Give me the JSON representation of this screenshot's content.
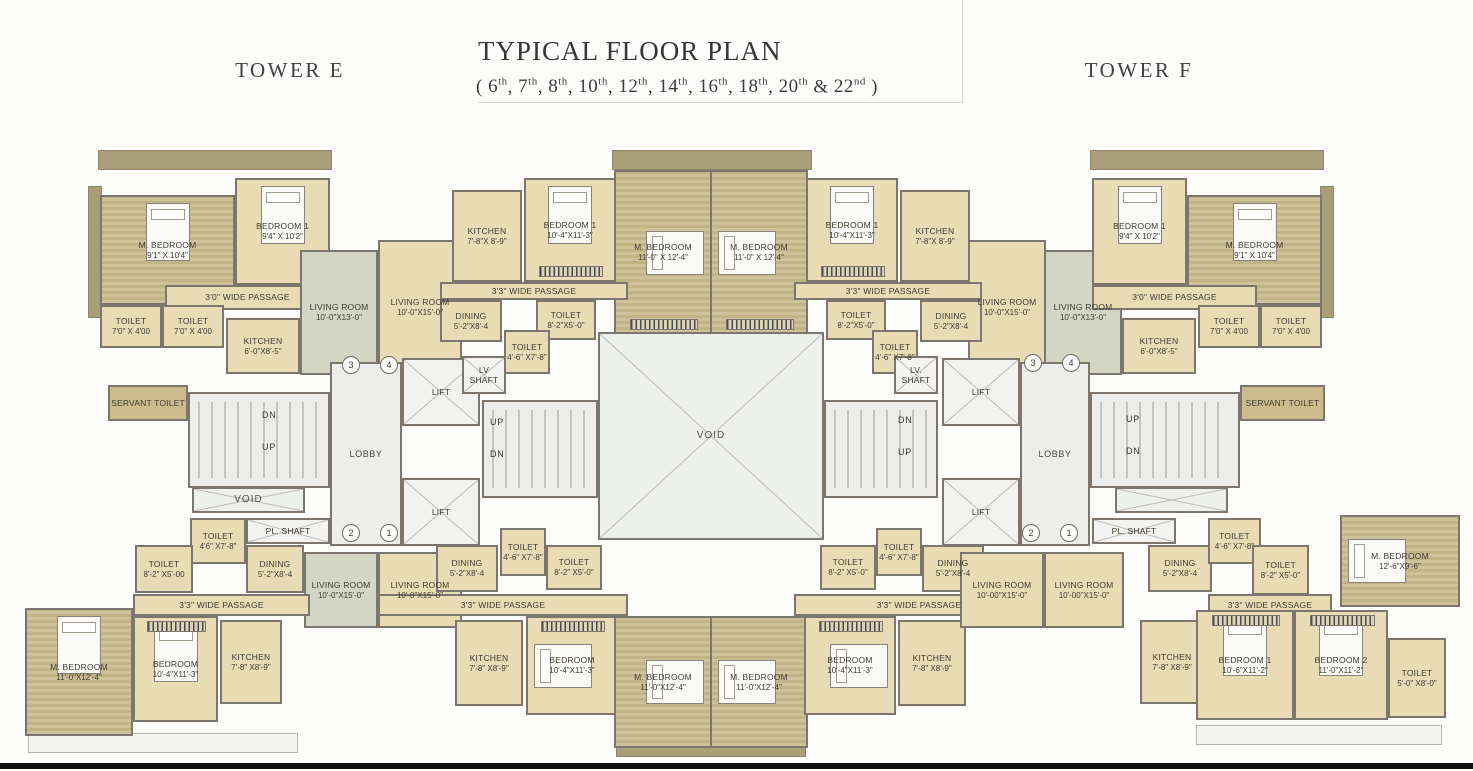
{
  "header": {
    "tower_left": "TOWER E",
    "title": "TYPICAL FLOOR PLAN",
    "floors_open": "(",
    "floors": [
      {
        "n": "6",
        "s": "th"
      },
      {
        "n": "7",
        "s": "th"
      },
      {
        "n": "8",
        "s": "th"
      },
      {
        "n": "10",
        "s": "th"
      },
      {
        "n": "12",
        "s": "th"
      },
      {
        "n": "14",
        "s": "th"
      },
      {
        "n": "16",
        "s": "th"
      },
      {
        "n": "18",
        "s": "th"
      },
      {
        "n": "20",
        "s": "th"
      },
      {
        "n": "22",
        "s": "nd"
      }
    ],
    "floors_close": ")",
    "tower_right": "TOWER F"
  },
  "colors": {
    "wall": "#7c766e",
    "room_cream": "#e9dcb4",
    "bedroom_khaki": "#cfc199",
    "living_sage": "#d3d6c4",
    "deck_olive": "#a89f79",
    "core_gray": "#ededeb",
    "servant_khaki": "#cbbb8d",
    "footer_black": "#121212"
  },
  "plan": {
    "rooms": [
      {
        "id": "deck-left",
        "t": "olive",
        "x": 88,
        "y": 186,
        "w": 14,
        "h": 132
      },
      {
        "id": "deck-top-left",
        "t": "olive",
        "x": 98,
        "y": 150,
        "w": 234,
        "h": 20
      },
      {
        "id": "deck-top-center",
        "t": "olive",
        "x": 612,
        "y": 150,
        "w": 200,
        "h": 20
      },
      {
        "id": "deck-top-right",
        "t": "olive",
        "x": 1090,
        "y": 150,
        "w": 234,
        "h": 20
      },
      {
        "id": "deck-right",
        "t": "olive",
        "x": 1320,
        "y": 186,
        "w": 14,
        "h": 132
      },
      {
        "id": "deck-bottom-left",
        "t": "white",
        "x": 28,
        "y": 733,
        "w": 270,
        "h": 20
      },
      {
        "id": "deck-bottom-center",
        "t": "olive",
        "x": 616,
        "y": 745,
        "w": 190,
        "h": 12
      },
      {
        "id": "deck-bottom-right",
        "t": "white",
        "x": 1196,
        "y": 725,
        "w": 246,
        "h": 20
      },
      {
        "id": "e1-mbedroom",
        "t": "khaki",
        "x": 100,
        "y": 195,
        "w": 135,
        "h": 110,
        "l": "M. BEDROOM",
        "d": "9'1\" X 10'4\"",
        "bed": "v"
      },
      {
        "id": "e1-bedroom1",
        "t": "cream",
        "x": 235,
        "y": 178,
        "w": 95,
        "h": 107,
        "l": "BEDROOM 1",
        "d": "9'4\" X 10'2\"",
        "bed": "v"
      },
      {
        "id": "e1-passage",
        "t": "cream",
        "x": 165,
        "y": 285,
        "w": 165,
        "h": 25,
        "l": "3'0\" WIDE PASSAGE"
      },
      {
        "id": "e1-toilet-1",
        "t": "cream",
        "x": 100,
        "y": 305,
        "w": 62,
        "h": 43,
        "l": "TOILET",
        "d": "7'0\" X 4'00"
      },
      {
        "id": "e1-toilet-2",
        "t": "cream",
        "x": 162,
        "y": 305,
        "w": 62,
        "h": 43,
        "l": "TOILET",
        "d": "7'0\" X 4'00"
      },
      {
        "id": "e1-kitchen",
        "t": "cream",
        "x": 226,
        "y": 318,
        "w": 74,
        "h": 56,
        "l": "KITCHEN",
        "d": "6'-0\"X8'-5\""
      },
      {
        "id": "e1-living",
        "t": "sage",
        "x": 300,
        "y": 250,
        "w": 78,
        "h": 125,
        "l": "LIVING ROOM",
        "d": "10'-0\"X13'-0\""
      },
      {
        "id": "e2-living",
        "t": "cream",
        "x": 378,
        "y": 240,
        "w": 84,
        "h": 135,
        "l": "LIVING ROOM",
        "d": "10'-0\"X15'-0\""
      },
      {
        "id": "e2-kitchen",
        "t": "cream",
        "x": 452,
        "y": 190,
        "w": 70,
        "h": 92,
        "l": "KITCHEN",
        "d": "7'-8\"X 8'-9\""
      },
      {
        "id": "e2-bedroom1",
        "t": "cream",
        "x": 524,
        "y": 178,
        "w": 92,
        "h": 104,
        "l": "BEDROOM 1",
        "d": "10'-4\"X11'-3\"",
        "bed": "v",
        "wr": "b"
      },
      {
        "id": "e2-mbedroom",
        "t": "khaki",
        "x": 614,
        "y": 170,
        "w": 98,
        "h": 165,
        "l": "M. BEDROOM",
        "d": "11'-0\" X 12'-4\"",
        "bed": "hr",
        "wr": "b"
      },
      {
        "id": "e2-passage",
        "t": "cream",
        "x": 440,
        "y": 282,
        "w": 188,
        "h": 18,
        "l": "3'3\" WIDE PASSAGE"
      },
      {
        "id": "e2-dining",
        "t": "cream",
        "x": 440,
        "y": 300,
        "w": 62,
        "h": 42,
        "l": "DINING",
        "d": "5'-2\"X8'-4"
      },
      {
        "id": "e2-toilet-82",
        "t": "cream",
        "x": 536,
        "y": 300,
        "w": 60,
        "h": 40,
        "l": "TOILET",
        "d": "8'-2\"X5'-0\""
      },
      {
        "id": "e2-toilet-46",
        "t": "cream",
        "x": 504,
        "y": 330,
        "w": 46,
        "h": 44,
        "l": "TOILET",
        "d": "4'-6\" X7'-8\""
      },
      {
        "id": "f2-mbedroom",
        "t": "khaki",
        "x": 710,
        "y": 170,
        "w": 98,
        "h": 165,
        "l": "M. BEDROOM",
        "d": "11'-0\" X 12'-4\"",
        "bed": "h",
        "wr": "b"
      },
      {
        "id": "f2-bedroom1",
        "t": "cream",
        "x": 806,
        "y": 178,
        "w": 92,
        "h": 104,
        "l": "BEDROOM 1",
        "d": "10'-4\"X11'-3\"",
        "bed": "v",
        "wr": "b"
      },
      {
        "id": "f2-kitchen",
        "t": "cream",
        "x": 900,
        "y": 190,
        "w": 70,
        "h": 92,
        "l": "KITCHEN",
        "d": "7'-8\"X 8'-9\""
      },
      {
        "id": "f2-living",
        "t": "cream",
        "x": 968,
        "y": 240,
        "w": 78,
        "h": 135,
        "l": "LIVING ROOM",
        "d": "10'-0\"X15'-0\""
      },
      {
        "id": "f2-passage",
        "t": "cream",
        "x": 794,
        "y": 282,
        "w": 188,
        "h": 18,
        "l": "3'3\" WIDE PASSAGE"
      },
      {
        "id": "f2-dining",
        "t": "cream",
        "x": 920,
        "y": 300,
        "w": 62,
        "h": 42,
        "l": "DINING",
        "d": "5'-2\"X8'-4"
      },
      {
        "id": "f2-toilet-82",
        "t": "cream",
        "x": 826,
        "y": 300,
        "w": 60,
        "h": 40,
        "l": "TOILET",
        "d": "8'-2\"X5'-0\""
      },
      {
        "id": "f2-toilet-46",
        "t": "cream",
        "x": 872,
        "y": 330,
        "w": 46,
        "h": 44,
        "l": "TOILET",
        "d": "4'-6\" X7'-8\""
      },
      {
        "id": "f1-living",
        "t": "sage",
        "x": 1044,
        "y": 250,
        "w": 78,
        "h": 125,
        "l": "LIVING ROOM",
        "d": "10'-0\"X13'-0\""
      },
      {
        "id": "f1-bedroom1",
        "t": "cream",
        "x": 1092,
        "y": 178,
        "w": 95,
        "h": 107,
        "l": "BEDROOM 1",
        "d": "9'4\" X 10'2\"",
        "bed": "v"
      },
      {
        "id": "f1-mbedroom",
        "t": "khaki",
        "x": 1187,
        "y": 195,
        "w": 135,
        "h": 110,
        "l": "M. BEDROOM",
        "d": "9'1\" X 10'4\"",
        "bed": "v"
      },
      {
        "id": "f1-passage",
        "t": "cream",
        "x": 1092,
        "y": 285,
        "w": 165,
        "h": 25,
        "l": "3'0\" WIDE PASSAGE"
      },
      {
        "id": "f1-kitchen",
        "t": "cream",
        "x": 1122,
        "y": 318,
        "w": 74,
        "h": 56,
        "l": "KITCHEN",
        "d": "6'-0\"X8'-5\""
      },
      {
        "id": "f1-toilet-1",
        "t": "cream",
        "x": 1198,
        "y": 305,
        "w": 62,
        "h": 43,
        "l": "TOILET",
        "d": "7'0\" X 4'00"
      },
      {
        "id": "f1-toilet-2",
        "t": "cream",
        "x": 1260,
        "y": 305,
        "w": 62,
        "h": 43,
        "l": "TOILET",
        "d": "7'0\" X 4'00"
      },
      {
        "id": "servant-toilet-left",
        "t": "servant",
        "x": 108,
        "y": 385,
        "w": 80,
        "h": 36,
        "l": "SERVANT TOILET"
      },
      {
        "id": "stair-left",
        "t": "core",
        "x": 188,
        "y": 392,
        "w": 142,
        "h": 96,
        "st": 1
      },
      {
        "id": "void-left",
        "t": "void",
        "x": 192,
        "y": 487,
        "w": 113,
        "h": 26,
        "l": "VOID"
      },
      {
        "id": "e3-toilet-46",
        "t": "cream",
        "x": 190,
        "y": 518,
        "w": 56,
        "h": 46,
        "l": "TOILET",
        "d": "4'6\" X7'-8\""
      },
      {
        "id": "pl-shaft-left",
        "t": "shaft",
        "x": 246,
        "y": 518,
        "w": 84,
        "h": 26,
        "l": "PL. SHAFT"
      },
      {
        "id": "lobby-left",
        "t": "core",
        "x": 330,
        "y": 362,
        "w": 72,
        "h": 184,
        "l": "LOBBY"
      },
      {
        "id": "lift-left-1",
        "t": "lift",
        "x": 402,
        "y": 358,
        "w": 78,
        "h": 68,
        "l": "LIFT"
      },
      {
        "id": "lift-left-2",
        "t": "lift",
        "x": 402,
        "y": 478,
        "w": 78,
        "h": 68,
        "l": "LIFT"
      },
      {
        "id": "lv-shaft-left",
        "t": "shaft",
        "x": 462,
        "y": 356,
        "w": 44,
        "h": 38,
        "l": "LV SHAFT"
      },
      {
        "id": "stair-mid-left",
        "t": "core",
        "x": 482,
        "y": 400,
        "w": 116,
        "h": 98,
        "st": 1
      },
      {
        "id": "void-center",
        "t": "void",
        "x": 598,
        "y": 332,
        "w": 226,
        "h": 208,
        "l": "VOID"
      },
      {
        "id": "stair-mid-right",
        "t": "core",
        "x": 824,
        "y": 400,
        "w": 114,
        "h": 98,
        "st": 1
      },
      {
        "id": "lv-shaft-right",
        "t": "shaft",
        "x": 894,
        "y": 356,
        "w": 44,
        "h": 38,
        "l": "LV. SHAFT"
      },
      {
        "id": "lift-right-1",
        "t": "lift",
        "x": 942,
        "y": 358,
        "w": 78,
        "h": 68,
        "l": "LIFT"
      },
      {
        "id": "lift-right-2",
        "t": "lift",
        "x": 942,
        "y": 478,
        "w": 78,
        "h": 68,
        "l": "LIFT"
      },
      {
        "id": "lobby-right",
        "t": "core",
        "x": 1020,
        "y": 362,
        "w": 70,
        "h": 184,
        "l": "LOBBY"
      },
      {
        "id": "stair-right",
        "t": "core",
        "x": 1090,
        "y": 392,
        "w": 150,
        "h": 96,
        "st": 1
      },
      {
        "id": "void-right",
        "t": "void",
        "x": 1115,
        "y": 487,
        "w": 113,
        "h": 26
      },
      {
        "id": "pl-shaft-right",
        "t": "shaft",
        "x": 1092,
        "y": 518,
        "w": 84,
        "h": 26,
        "l": "PL. SHAFT"
      },
      {
        "id": "servant-toilet-right",
        "t": "servant",
        "x": 1240,
        "y": 385,
        "w": 85,
        "h": 36,
        "l": "SERVANT TOILET"
      },
      {
        "id": "e3-toilet-82",
        "t": "cream",
        "x": 135,
        "y": 545,
        "w": 58,
        "h": 48,
        "l": "TOILET",
        "d": "8'-2\" X5'-00"
      },
      {
        "id": "e3-dining",
        "t": "cream",
        "x": 246,
        "y": 545,
        "w": 58,
        "h": 48,
        "l": "DINING",
        "d": "5'-2\"X8'-4"
      },
      {
        "id": "e3-living",
        "t": "sage",
        "x": 304,
        "y": 552,
        "w": 74,
        "h": 76,
        "l": "LIVING ROOM",
        "d": "10'-0\"X15'-0\""
      },
      {
        "id": "e3-passage",
        "t": "cream",
        "x": 133,
        "y": 594,
        "w": 177,
        "h": 22,
        "l": "3'3\" WIDE PASSAGE"
      },
      {
        "id": "e3-mbedroom",
        "t": "khaki",
        "x": 25,
        "y": 608,
        "w": 108,
        "h": 128,
        "l": "M. BEDROOM",
        "d": "11'-0\"X12'-4\"",
        "bed": "v"
      },
      {
        "id": "e3-bedroom",
        "t": "cream",
        "x": 133,
        "y": 616,
        "w": 85,
        "h": 106,
        "l": "BEDROOM",
        "d": "10'-4\"X11'-3\"",
        "bed": "v",
        "wr": "t"
      },
      {
        "id": "e3-kitchen",
        "t": "cream",
        "x": 220,
        "y": 620,
        "w": 62,
        "h": 84,
        "l": "KITCHEN",
        "d": "7'-8\" X8'-9\""
      },
      {
        "id": "e4-living",
        "t": "cream",
        "x": 378,
        "y": 552,
        "w": 84,
        "h": 76,
        "l": "LIVING ROOM",
        "d": "10'-0\"X15'-0\""
      },
      {
        "id": "e4-dining",
        "t": "cream",
        "x": 436,
        "y": 545,
        "w": 62,
        "h": 47,
        "l": "DINING",
        "d": "5'-2\"X8'-4"
      },
      {
        "id": "e4-toilet-46",
        "t": "cream",
        "x": 500,
        "y": 528,
        "w": 46,
        "h": 48,
        "l": "TOILET",
        "d": "4'-6\" X7'-8\""
      },
      {
        "id": "e4-toilet-82",
        "t": "cream",
        "x": 546,
        "y": 545,
        "w": 56,
        "h": 45,
        "l": "TOILET",
        "d": "8'-2\" X5'-0\""
      },
      {
        "id": "e4-passage",
        "t": "cream",
        "x": 378,
        "y": 594,
        "w": 250,
        "h": 22,
        "l": "3'3\" WIDE PASSAGE"
      },
      {
        "id": "e4-kitchen",
        "t": "cream",
        "x": 455,
        "y": 620,
        "w": 68,
        "h": 86,
        "l": "KITCHEN",
        "d": "7'-8\" X8'-9\""
      },
      {
        "id": "e4-bedroom",
        "t": "cream",
        "x": 526,
        "y": 616,
        "w": 92,
        "h": 99,
        "l": "BEDROOM",
        "d": "10'-4\"X11'-3\"",
        "bed": "h",
        "wr": "t"
      },
      {
        "id": "e4-mbedroom",
        "t": "khaki",
        "x": 614,
        "y": 616,
        "w": 98,
        "h": 132,
        "l": "M. BEDROOM",
        "d": "11'-0\"X12'-4\"",
        "bed": "hr"
      },
      {
        "id": "f3-mbedroom",
        "t": "khaki",
        "x": 710,
        "y": 616,
        "w": 98,
        "h": 132,
        "l": "M. BEDROOM",
        "d": "11'-0\"X12'-4\"",
        "bed": "h"
      },
      {
        "id": "f3-bedroom",
        "t": "cream",
        "x": 804,
        "y": 616,
        "w": 92,
        "h": 99,
        "l": "BEDROOM",
        "d": "10'-4\"X11'-3\"",
        "bed": "hr",
        "wr": "t"
      },
      {
        "id": "f3-kitchen",
        "t": "cream",
        "x": 898,
        "y": 620,
        "w": 68,
        "h": 86,
        "l": "KITCHEN",
        "d": "7'-8\" X8'-9\""
      },
      {
        "id": "f3-passage",
        "t": "cream",
        "x": 794,
        "y": 594,
        "w": 250,
        "h": 22,
        "l": "3'3\" WIDE PASSAGE"
      },
      {
        "id": "f3-toilet-82",
        "t": "cream",
        "x": 820,
        "y": 545,
        "w": 56,
        "h": 45,
        "l": "TOILET",
        "d": "8'-2\" X5'-0\""
      },
      {
        "id": "f3-toilet-46",
        "t": "cream",
        "x": 876,
        "y": 528,
        "w": 46,
        "h": 48,
        "l": "TOILET",
        "d": "4'-6\" X7'-8\""
      },
      {
        "id": "f3-dining",
        "t": "cream",
        "x": 922,
        "y": 545,
        "w": 62,
        "h": 47,
        "l": "DINING",
        "d": "5'-2\"X8'-4"
      },
      {
        "id": "f3-living-1",
        "t": "cream",
        "x": 960,
        "y": 552,
        "w": 84,
        "h": 76,
        "l": "LIVING ROOM",
        "d": "10'-00\"X15'-0\""
      },
      {
        "id": "f3-living-2",
        "t": "cream",
        "x": 1044,
        "y": 552,
        "w": 80,
        "h": 76,
        "l": "LIVING ROOM",
        "d": "10'-00\"X15'-0\""
      },
      {
        "id": "f4-dining",
        "t": "cream",
        "x": 1148,
        "y": 545,
        "w": 64,
        "h": 47,
        "l": "DINING",
        "d": "5'-2\"X8'-4"
      },
      {
        "id": "f4-toilet-46",
        "t": "cream",
        "x": 1208,
        "y": 518,
        "w": 53,
        "h": 46,
        "l": "TOILET",
        "d": "4'-6\" X7'-8\""
      },
      {
        "id": "f4-toilet-82",
        "t": "cream",
        "x": 1252,
        "y": 545,
        "w": 57,
        "h": 50,
        "l": "TOILET",
        "d": "8'-2\" X5'-0\""
      },
      {
        "id": "f4-passage",
        "t": "cream",
        "x": 1208,
        "y": 594,
        "w": 124,
        "h": 22,
        "l": "3'3\" WIDE PASSAGE"
      },
      {
        "id": "f4-mbedroom",
        "t": "khaki",
        "x": 1340,
        "y": 515,
        "w": 120,
        "h": 92,
        "l": "M. BEDROOM",
        "d": "12'-6\"X9'-6\"",
        "bed": "h"
      },
      {
        "id": "f4-kitchen",
        "t": "cream",
        "x": 1140,
        "y": 620,
        "w": 64,
        "h": 84,
        "l": "KITCHEN",
        "d": "7'-8\" X8'-9\""
      },
      {
        "id": "f4-bedroom1",
        "t": "cream",
        "x": 1196,
        "y": 610,
        "w": 98,
        "h": 110,
        "l": "BEDROOM 1",
        "d": "10'-6\"X11'-2\"",
        "bed": "v",
        "wr": "t"
      },
      {
        "id": "f4-bedroom2",
        "t": "cream",
        "x": 1294,
        "y": 610,
        "w": 94,
        "h": 110,
        "l": "BEDROOM 2",
        "d": "11'-0\"X11'-2\"",
        "bed": "v",
        "wr": "t"
      },
      {
        "id": "f4-toilet-50",
        "t": "cream",
        "x": 1388,
        "y": 638,
        "w": 58,
        "h": 80,
        "l": "TOILET",
        "d": "5'-0\" X8'-0\""
      }
    ],
    "badges": [
      {
        "n": "3",
        "x": 342,
        "y": 356
      },
      {
        "n": "4",
        "x": 380,
        "y": 356
      },
      {
        "n": "2",
        "x": 342,
        "y": 524
      },
      {
        "n": "1",
        "x": 380,
        "y": 524
      },
      {
        "n": "3",
        "x": 1024,
        "y": 354
      },
      {
        "n": "4",
        "x": 1062,
        "y": 354
      },
      {
        "n": "2",
        "x": 1022,
        "y": 524
      },
      {
        "n": "1",
        "x": 1060,
        "y": 524
      }
    ],
    "annotations": [
      {
        "t": "DN",
        "x": 262,
        "y": 410
      },
      {
        "t": "UP",
        "x": 262,
        "y": 442
      },
      {
        "t": "UP",
        "x": 490,
        "y": 417
      },
      {
        "t": "DN",
        "x": 490,
        "y": 449
      },
      {
        "t": "DN",
        "x": 898,
        "y": 415
      },
      {
        "t": "UP",
        "x": 898,
        "y": 447
      },
      {
        "t": "UP",
        "x": 1126,
        "y": 414
      },
      {
        "t": "DN",
        "x": 1126,
        "y": 446
      }
    ]
  }
}
